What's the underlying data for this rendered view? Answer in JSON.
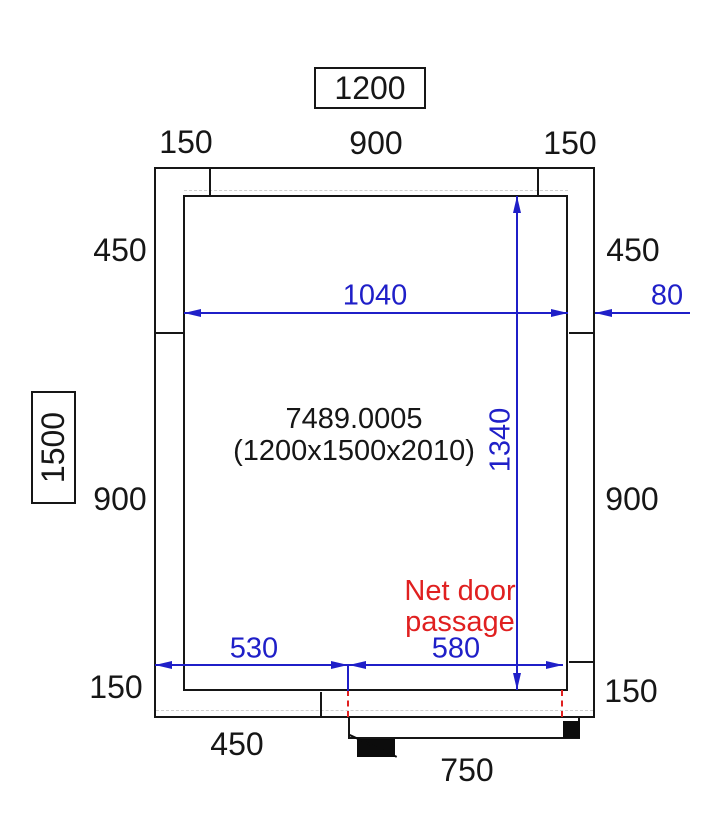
{
  "meta": {
    "type": "cold-room floor plan technical drawing",
    "units": "mm"
  },
  "colors": {
    "line": "#161616",
    "dimension_blue": "#1f1fc8",
    "warning_red": "#e02020"
  },
  "product": {
    "code": "7489.0005",
    "size": "(1200x1500x2010)"
  },
  "overall": {
    "width_boxed": "1200",
    "depth_boxed": "1500"
  },
  "dims": {
    "top_left": "150",
    "top_center": "900",
    "top_right": "150",
    "left_upper": "450",
    "right_upper": "450",
    "left_mid": "900",
    "right_mid": "900",
    "bottom_left": "150",
    "bottom_right": "150",
    "bottom_offset": "450",
    "door_outer_width": "750",
    "inner_width": "1040",
    "wall_thickness": "80",
    "inner_depth": "1340",
    "door_left_offset": "530",
    "net_door_passage": "580"
  },
  "notes": {
    "door_note_line1": "Net door",
    "door_note_line2": "passage"
  }
}
